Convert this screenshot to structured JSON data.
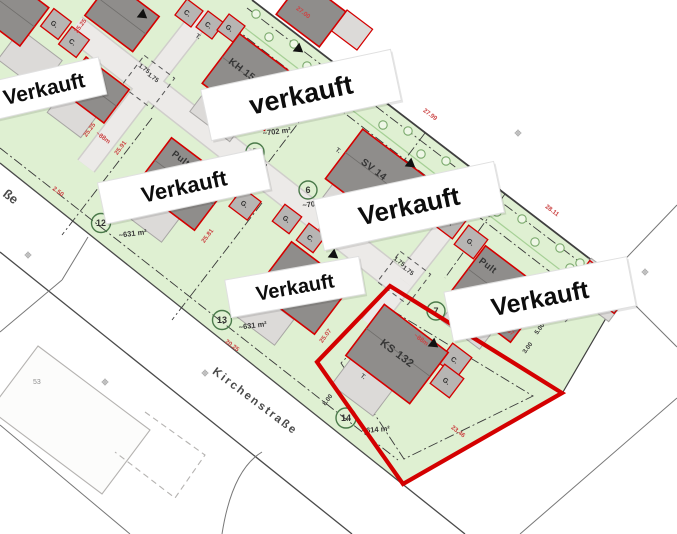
{
  "streets": {
    "main": "Kirchenstraße",
    "left_fragment": "ße"
  },
  "stickers": {
    "v1": "Verkauft",
    "v2": "verkauft",
    "v3": "Verkauft",
    "v4": "Verkauft",
    "v5": "Verkauft",
    "v6": "Verkauft"
  },
  "plots": {
    "p5": {
      "number": "5",
      "area": "~702 m²"
    },
    "p6": {
      "number": "6",
      "area": "~70"
    },
    "p7": {
      "number": "7"
    },
    "p12": {
      "number": "12",
      "area": "~631 m²"
    },
    "p13": {
      "number": "13",
      "area": "~631 m²"
    },
    "p14": {
      "number": "14",
      "area": "~614 m²"
    }
  },
  "houses": {
    "kh": "KH 15",
    "sv": "SV 14",
    "ks": "KS 132",
    "pult7": "Pult",
    "pult12": "Pult",
    "terrace": "T."
  },
  "garages": {
    "c": "C.",
    "g": "G."
  },
  "neighbor": {
    "house_number": "53"
  },
  "dims": [
    {
      "t": "27.00"
    },
    {
      "t": "27.99"
    },
    {
      "t": "28.11"
    },
    {
      "t": "25.25"
    },
    {
      "t": "25.25"
    },
    {
      "t": "~88m"
    },
    {
      "t": "25.91"
    },
    {
      "t": "25.81"
    },
    {
      "t": "25.96"
    },
    {
      "t": "20.25"
    },
    {
      "t": "2.50"
    },
    {
      "t": "25.07"
    },
    {
      "t": "28.67"
    },
    {
      "t": "23.46"
    },
    {
      "t": "~88m"
    },
    {
      "t": "1.75"
    },
    {
      "t": "1.75"
    },
    {
      "t": "1.75"
    },
    {
      "t": "1.75"
    },
    {
      "t": "8.00"
    },
    {
      "t": "5.00"
    },
    {
      "t": "3.00"
    }
  ],
  "colors": {
    "sold_red": "#d40000",
    "plot_green": "#dff0d2",
    "roof_gray": "#8f8d8b",
    "road_gray": "#eceae8"
  }
}
